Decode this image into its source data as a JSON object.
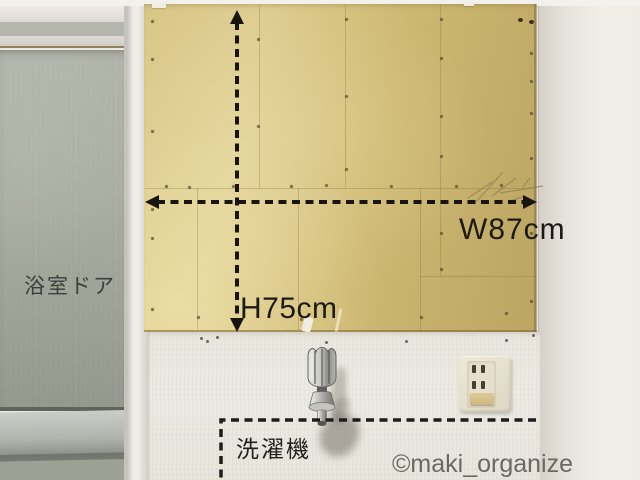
{
  "labels": {
    "door": "浴室ドア",
    "height": "H75cm",
    "width": "W87cm",
    "washer": "洗濯機",
    "watermark": "©maki_organize"
  },
  "measurements": {
    "board_width_cm": 87,
    "board_height_cm": 75
  },
  "colors": {
    "board_tan": "#cdb871",
    "board_light": "#dccb8e",
    "wall_white": "#eae7e0",
    "door_glass": "#a8ab9f",
    "annotation_black": "#1c1a15",
    "watermark_gray": "#5f5d57",
    "outlet_plate": "#e6dfcc",
    "outlet_earth_flap": "#d5c28c"
  },
  "objects": {
    "board": "mdf-board",
    "door": "bathroom-door",
    "faucet": "water-faucet",
    "outlet": "power-outlet",
    "washer_area": "washing-machine-outline"
  }
}
